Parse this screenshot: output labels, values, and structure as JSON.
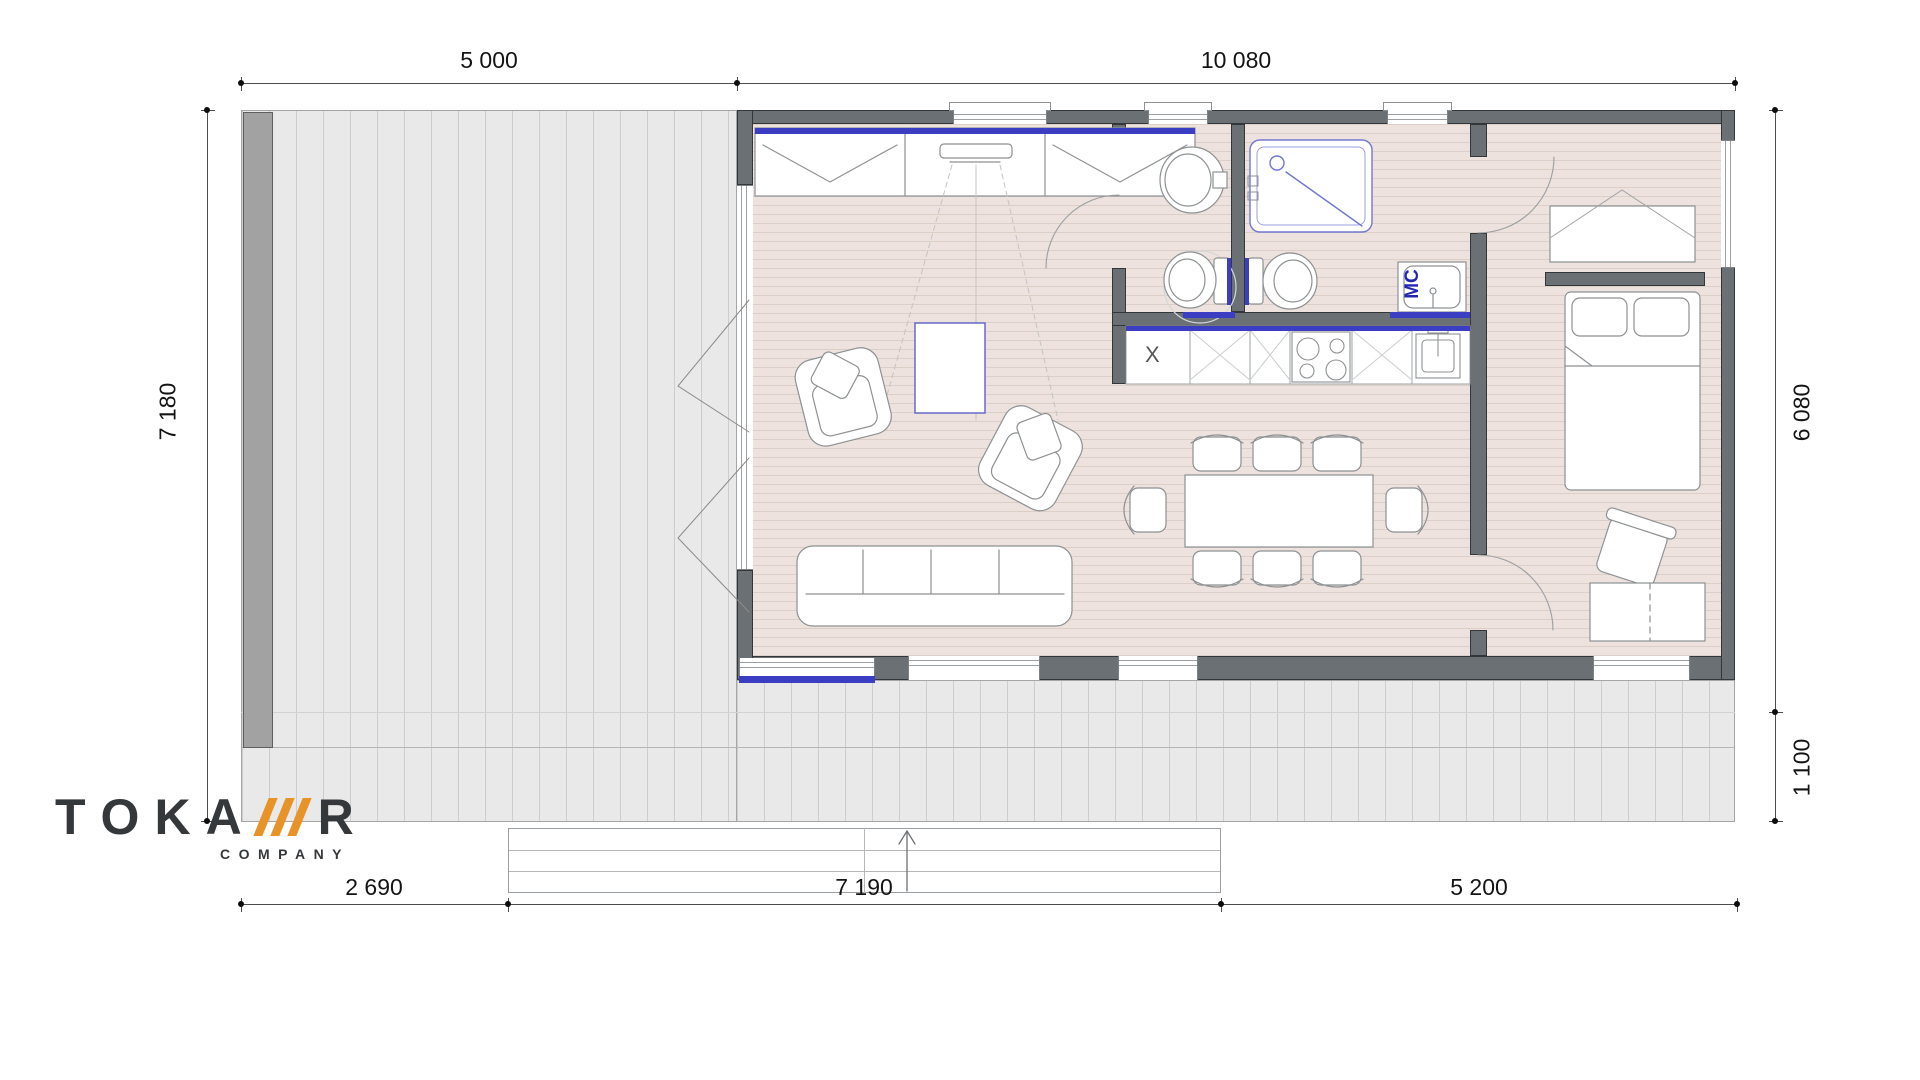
{
  "dimensions": {
    "top_deck": "5 000",
    "top_building": "10 080",
    "left_total": "7 180",
    "right_depth": "6 080",
    "right_step": "1 100",
    "bottom_left": "2 690",
    "bottom_center": "7 190",
    "bottom_right": "5 200"
  },
  "labels": {
    "washing_machine": "MC",
    "kitchen_appliance": "X"
  },
  "logo": {
    "letters": [
      "T",
      "O",
      "K",
      "A"
    ],
    "last_letter": "R",
    "subtitle": "COMPANY",
    "slash_count": 3
  },
  "colors": {
    "accent_blue": "#3b3ec2",
    "logo_orange": "#e79328",
    "wall_gray": "#6b7074",
    "floor_wood": "#ede2dd",
    "deck_gray": "#e9e9e9",
    "sanitary_outline": "#7277cf"
  }
}
